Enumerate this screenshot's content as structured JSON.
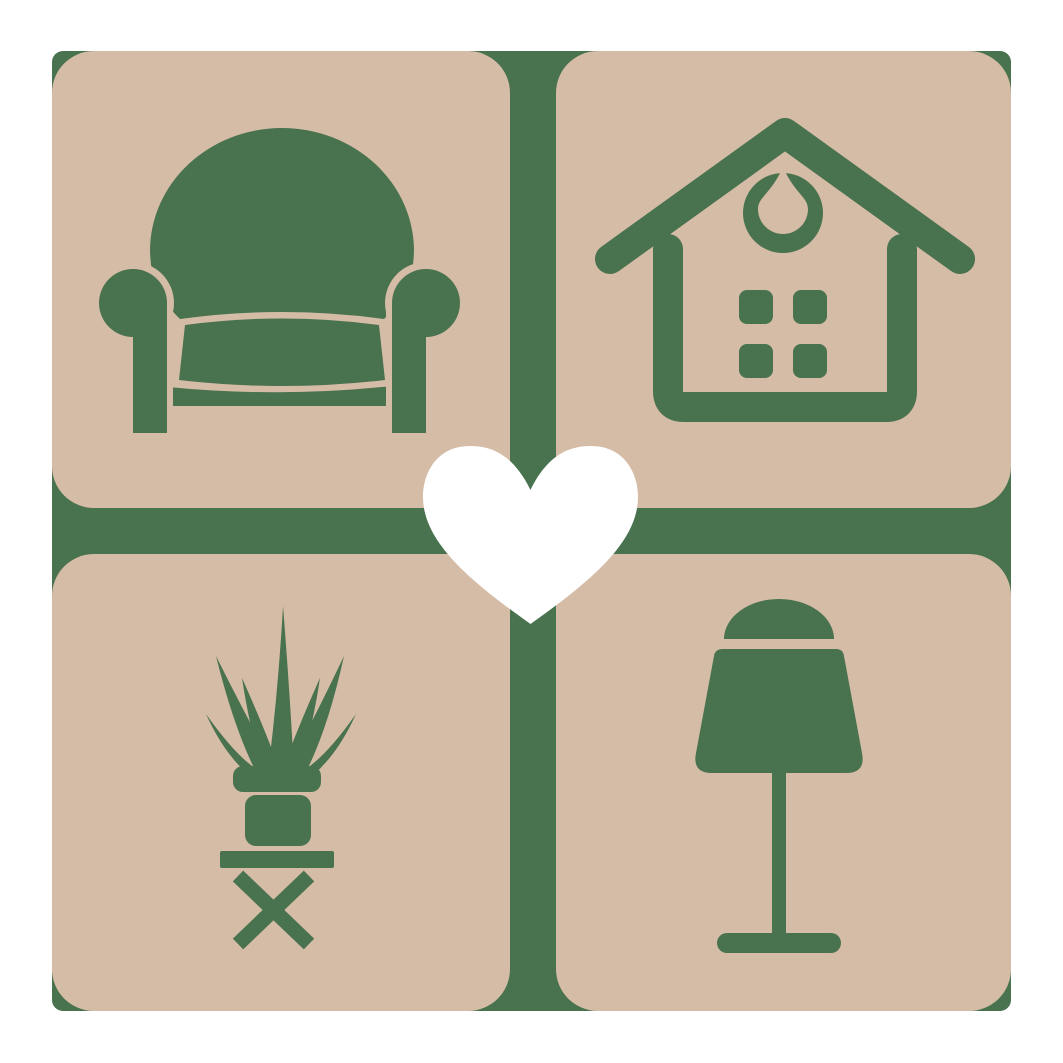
{
  "colors": {
    "background": "#ffffff",
    "accent-green": "#49724E",
    "tile-tan": "#D5BCA6",
    "heart": "#ffffff"
  },
  "logo": {
    "layout": "2x2-rounded-tile-grid-with-center-heart",
    "center_icon": "heart-icon",
    "tiles": [
      {
        "position": "top-left",
        "icon": "armchair-icon"
      },
      {
        "position": "top-right",
        "icon": "house-icon"
      },
      {
        "position": "bottom-left",
        "icon": "potted-plant-icon"
      },
      {
        "position": "bottom-right",
        "icon": "table-lamp-icon"
      }
    ]
  }
}
